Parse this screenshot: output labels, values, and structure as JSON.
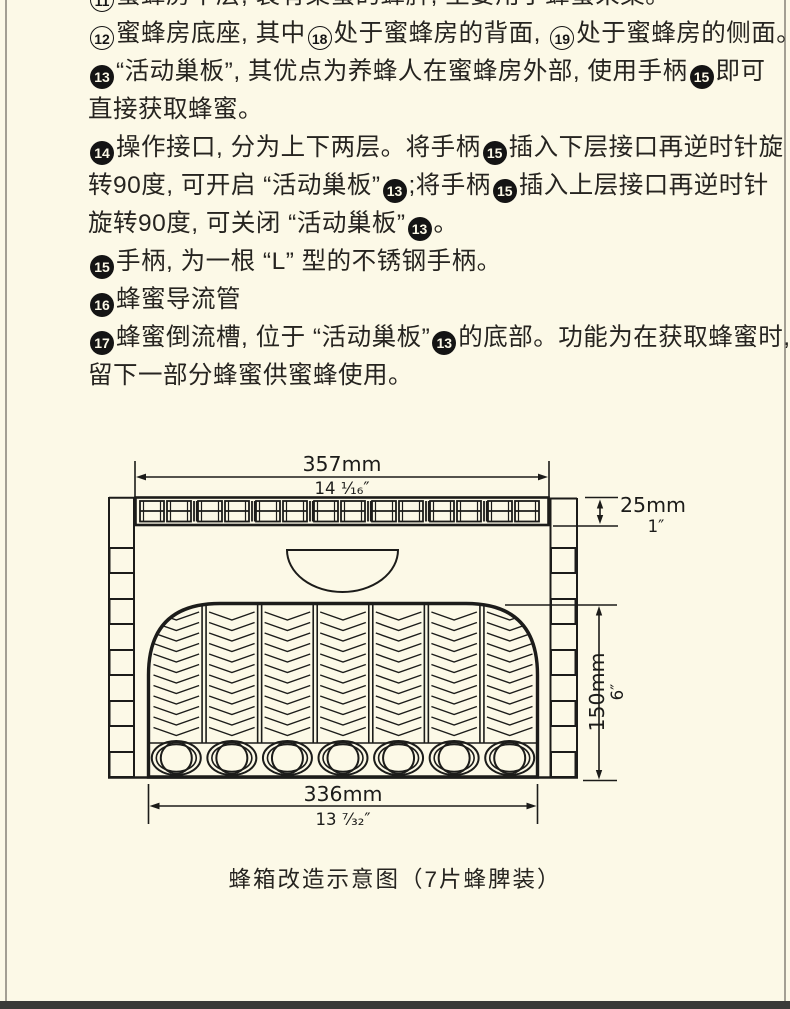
{
  "page": {
    "background": "#fcf9e7",
    "text_color": "#262420",
    "edge_rule_color": "#a39f93",
    "footer_bar_color": "#3a3a38",
    "badge_filled_color": "#141414"
  },
  "description": {
    "lines": [
      {
        "clipped": true,
        "segments": [
          {
            "badge": "11",
            "filled": false
          },
          {
            "text": "蜜蜂房中层, 装有集蜜的蜂脾, 主要用于蜂蜜采集。"
          }
        ]
      },
      {
        "segments": [
          {
            "badge": "12",
            "filled": false
          },
          {
            "text": "蜜蜂房底座, 其中"
          },
          {
            "badge": "18",
            "filled": false
          },
          {
            "text": "处于蜜蜂房的背面, "
          },
          {
            "badge": "19",
            "filled": false
          },
          {
            "text": "处于蜜蜂房的侧面。"
          }
        ]
      },
      {
        "segments": [
          {
            "badge": "13",
            "filled": true
          },
          {
            "text": "“活动巢板”, 其优点为养蜂人在蜜蜂房外部, 使用手柄"
          },
          {
            "badge": "15",
            "filled": true
          },
          {
            "text": "即可"
          }
        ]
      },
      {
        "segments": [
          {
            "text": "直接获取蜂蜜。"
          }
        ]
      },
      {
        "segments": [
          {
            "badge": "14",
            "filled": true
          },
          {
            "text": "操作接口, 分为上下两层。将手柄"
          },
          {
            "badge": "15",
            "filled": true
          },
          {
            "text": "插入下层接口再逆时针旋"
          }
        ]
      },
      {
        "segments": [
          {
            "text": "转90度, 可开启 “活动巢板”"
          },
          {
            "badge": "13",
            "filled": true
          },
          {
            "text": ";将手柄"
          },
          {
            "badge": "15",
            "filled": true
          },
          {
            "text": "插入上层接口再逆时针"
          }
        ]
      },
      {
        "segments": [
          {
            "text": "旋转90度, 可关闭 “活动巢板”"
          },
          {
            "badge": "13",
            "filled": true
          },
          {
            "text": "。"
          }
        ]
      },
      {
        "segments": [
          {
            "badge": "15",
            "filled": true
          },
          {
            "text": "手柄, 为一根 “L” 型的不锈钢手柄。"
          }
        ]
      },
      {
        "segments": [
          {
            "badge": "16",
            "filled": true
          },
          {
            "text": "蜂蜜导流管"
          }
        ]
      },
      {
        "segments": [
          {
            "badge": "17",
            "filled": true
          },
          {
            "text": "蜂蜜倒流槽, 位于 “活动巢板”"
          },
          {
            "badge": "13",
            "filled": true
          },
          {
            "text": "的底部。功能为在获取蜂蜜时,"
          }
        ]
      },
      {
        "segments": [
          {
            "text": "留下一部分蜂蜜供蜜蜂使用。"
          }
        ]
      }
    ]
  },
  "diagram": {
    "caption": "蜂箱改造示意图（7片蜂脾装）",
    "frame_count": 7,
    "dimensions": {
      "width_top": {
        "mm": "357mm",
        "inch": "14 ¹⁄₁₆″"
      },
      "lid_height": {
        "mm": "25mm",
        "inch": "1″"
      },
      "body_height": {
        "mm": "150mm",
        "inch": "6″"
      },
      "width_bottom": {
        "mm": "336mm",
        "inch": "13 ⁷⁄₃₂″"
      }
    }
  }
}
